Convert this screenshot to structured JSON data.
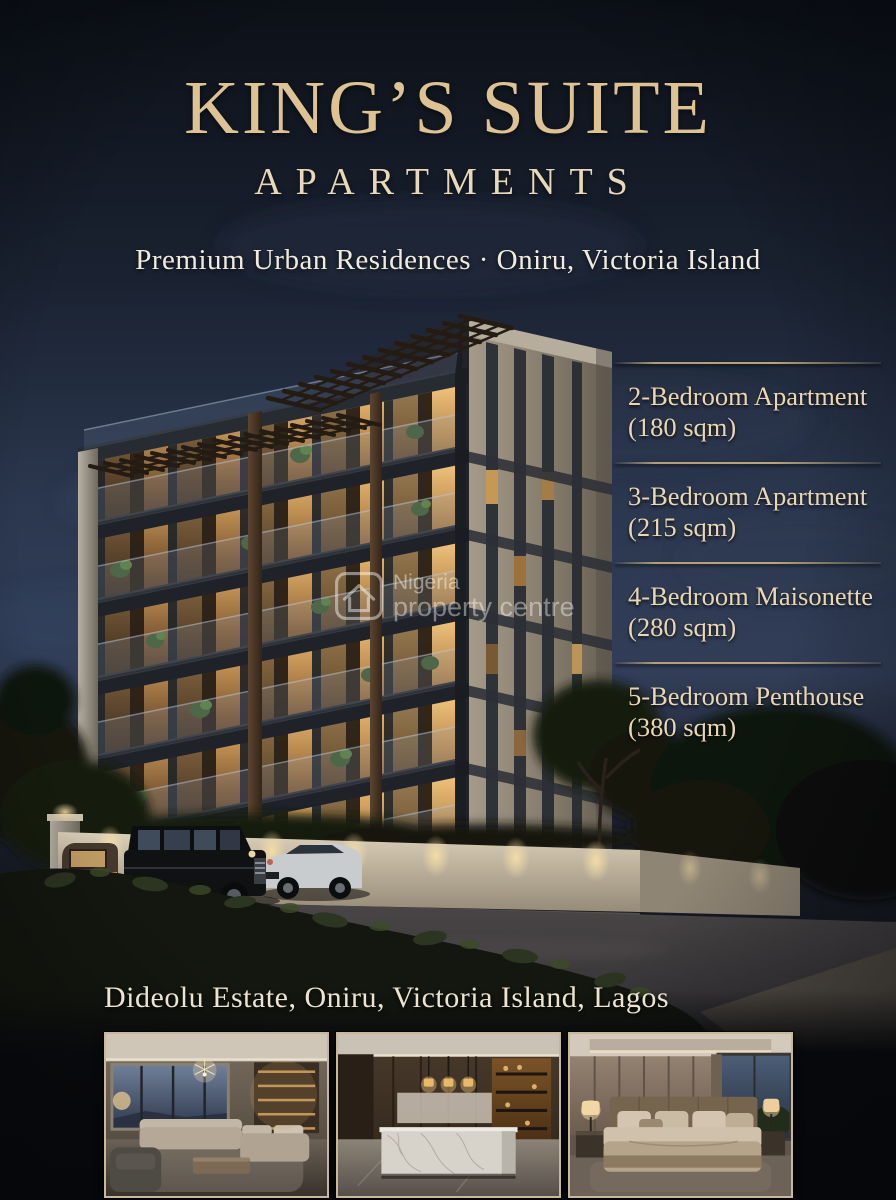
{
  "poster": {
    "title": "KING’S SUITE",
    "subtitle": "APARTMENTS",
    "tagline": "Premium Urban Residences  ·  Oniru, Victoria Island",
    "address": "Dideolu Estate, Oniru, Victoria Island, Lagos"
  },
  "units": [
    {
      "name": "2-Bedroom Apartment",
      "size": "(180 sqm)"
    },
    {
      "name": "3-Bedroom Apartment",
      "size": "(215 sqm)"
    },
    {
      "name": "4-Bedroom Maisonette",
      "size": "(280 sqm)"
    },
    {
      "name": "5-Bedroom Penthouse",
      "size": "(380 sqm)"
    }
  ],
  "watermark": {
    "icon": "house-icon",
    "line1": "Nigeria",
    "line2": "property centre"
  },
  "colors": {
    "accent_gold": "#ddc293",
    "text_cream": "#e9d7b2",
    "background_navy": "#0d1119",
    "divider_gold": "#c9b17e",
    "watermark_white": "#ffffff"
  }
}
